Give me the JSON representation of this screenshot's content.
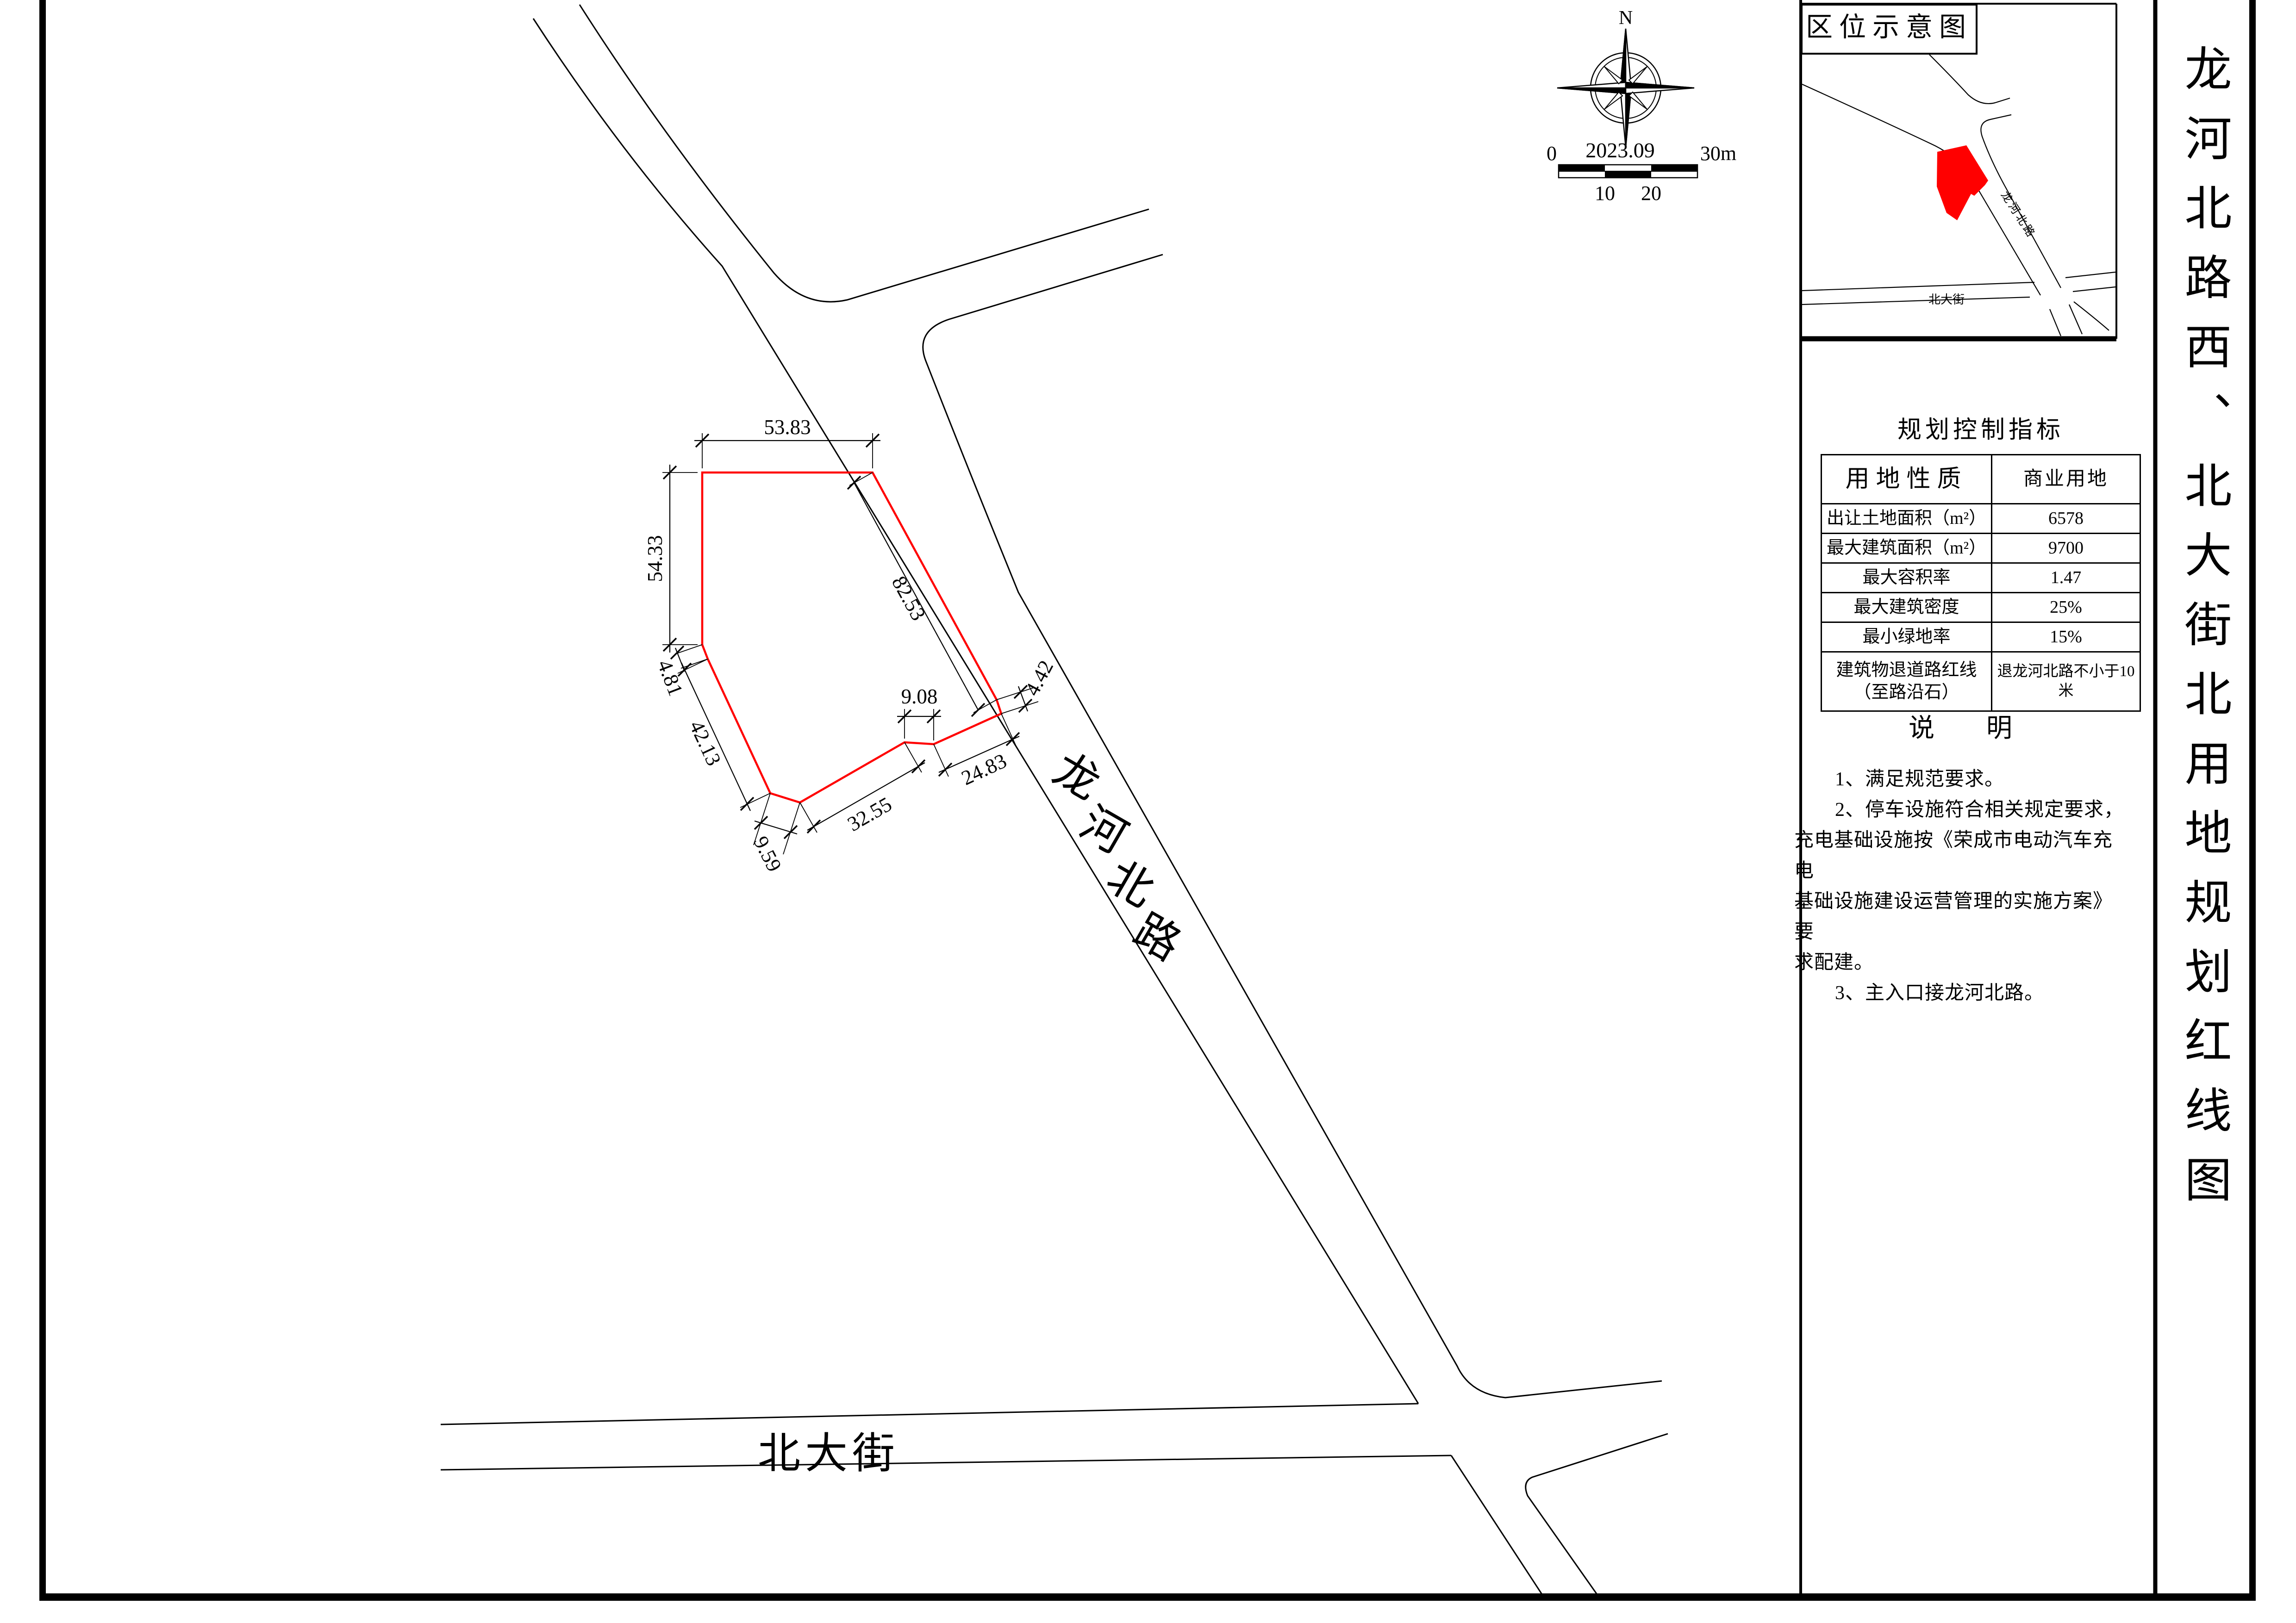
{
  "sheet_title": "龙河北路西、北大街北用地规划红线图",
  "colors": {
    "parcel_red": "#ff0000",
    "line_black": "#000000"
  },
  "inset": {
    "title": "区位示意图",
    "road_label": "龙河北路",
    "street_label": "北大街"
  },
  "compass": {
    "north_label": "N"
  },
  "scale_bar": {
    "zero": "0",
    "date": "2023.09",
    "end": "30m",
    "tick10": "10",
    "tick20": "20"
  },
  "map": {
    "road_chars": [
      "龙",
      "河",
      "北",
      "路"
    ],
    "street_label": "北大街",
    "dims": {
      "top": "53.83",
      "left": "54.33",
      "d481": "4.81",
      "d4213": "42.13",
      "d959": "9.59",
      "d3255": "32.55",
      "d908": "9.08",
      "d2483": "24.83",
      "d442": "4.42",
      "d8253": "82.53"
    }
  },
  "table": {
    "title": "规划控制指标",
    "rows": [
      {
        "label": "用地性质",
        "value": "商业用地"
      },
      {
        "label": "出让土地面积（m²）",
        "value": "6578"
      },
      {
        "label": "最大建筑面积（m²）",
        "value": "9700"
      },
      {
        "label": "最大容积率",
        "value": "1.47"
      },
      {
        "label": "最大建筑密度",
        "value": "25%"
      },
      {
        "label": "最小绿地率",
        "value": "15%"
      },
      {
        "label": "建筑物退道路红线（至路沿石）",
        "value": "退龙河北路不小于10米"
      }
    ]
  },
  "notes": {
    "title": "说　　明",
    "lines": [
      "1、满足规范要求。",
      "2、停车设施符合相关规定要求，",
      "充电基础设施按《荣成市电动汽车充电",
      "基础设施建设运营管理的实施方案》要",
      "求配建。",
      "3、主入口接龙河北路。"
    ]
  }
}
